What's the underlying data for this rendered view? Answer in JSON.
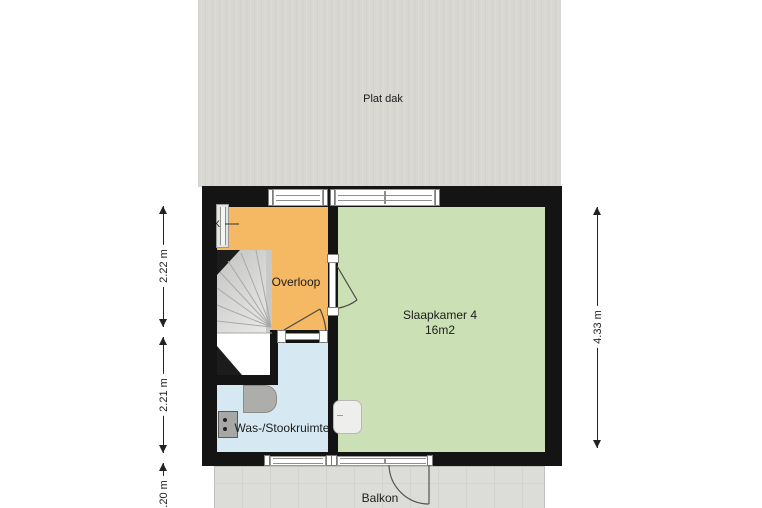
{
  "roof": {
    "label": "Plat dak",
    "color": "#d8d7d2"
  },
  "rooms": {
    "overloop": {
      "label": "Overloop",
      "color": "#f5b964"
    },
    "slaapkamer": {
      "label": "Slaapkamer 4",
      "area": "16m2",
      "color": "#cbe0b4"
    },
    "wasruimte": {
      "label": "Was-/Stookruimte",
      "color": "#d6e9f2"
    }
  },
  "balcony": {
    "label": "Balkon",
    "color": "#dcdcd9"
  },
  "walls": {
    "color": "#141414"
  },
  "annotations": {
    "window_marker": "K"
  },
  "dimensions": {
    "left": [
      {
        "label": "2.22 m"
      },
      {
        "label": "2.21 m"
      },
      {
        "label": "1.20 m"
      }
    ],
    "right": {
      "label": "4.33 m"
    }
  }
}
